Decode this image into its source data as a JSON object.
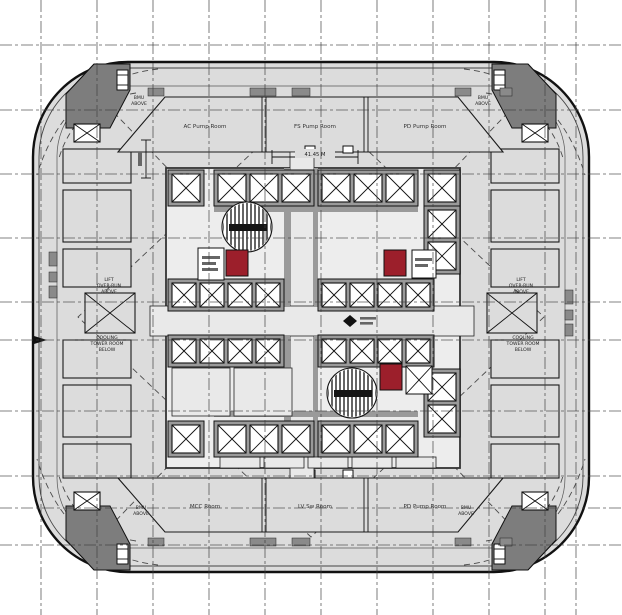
{
  "rooms": {
    "top": [
      "AC Pump Room",
      "FS Pump Room",
      "PD Pump Room"
    ],
    "bottom": [
      "MCC Room",
      "LV Sw Room",
      "PD Pump Room"
    ]
  },
  "annotations": {
    "corner": {
      "line1": "BMU",
      "line2": "ABOVE"
    },
    "lift_overrun": {
      "line1": "LIFT",
      "line2": "OVER-RUN",
      "line3": "ABOVE"
    },
    "cooling_tower": {
      "line1": "COOLING",
      "line2": "TOWER ROOM",
      "line3": "BELOW"
    }
  },
  "dimension": {
    "core_width": "41.45 M"
  },
  "colors": {
    "floor": "#dcdcdc",
    "corner_block": "#7d7d7d",
    "wall": "#9a9a9a",
    "equipment_red": "#9c1f2b",
    "line": "#1a1a1a",
    "background": "#ffffff"
  }
}
